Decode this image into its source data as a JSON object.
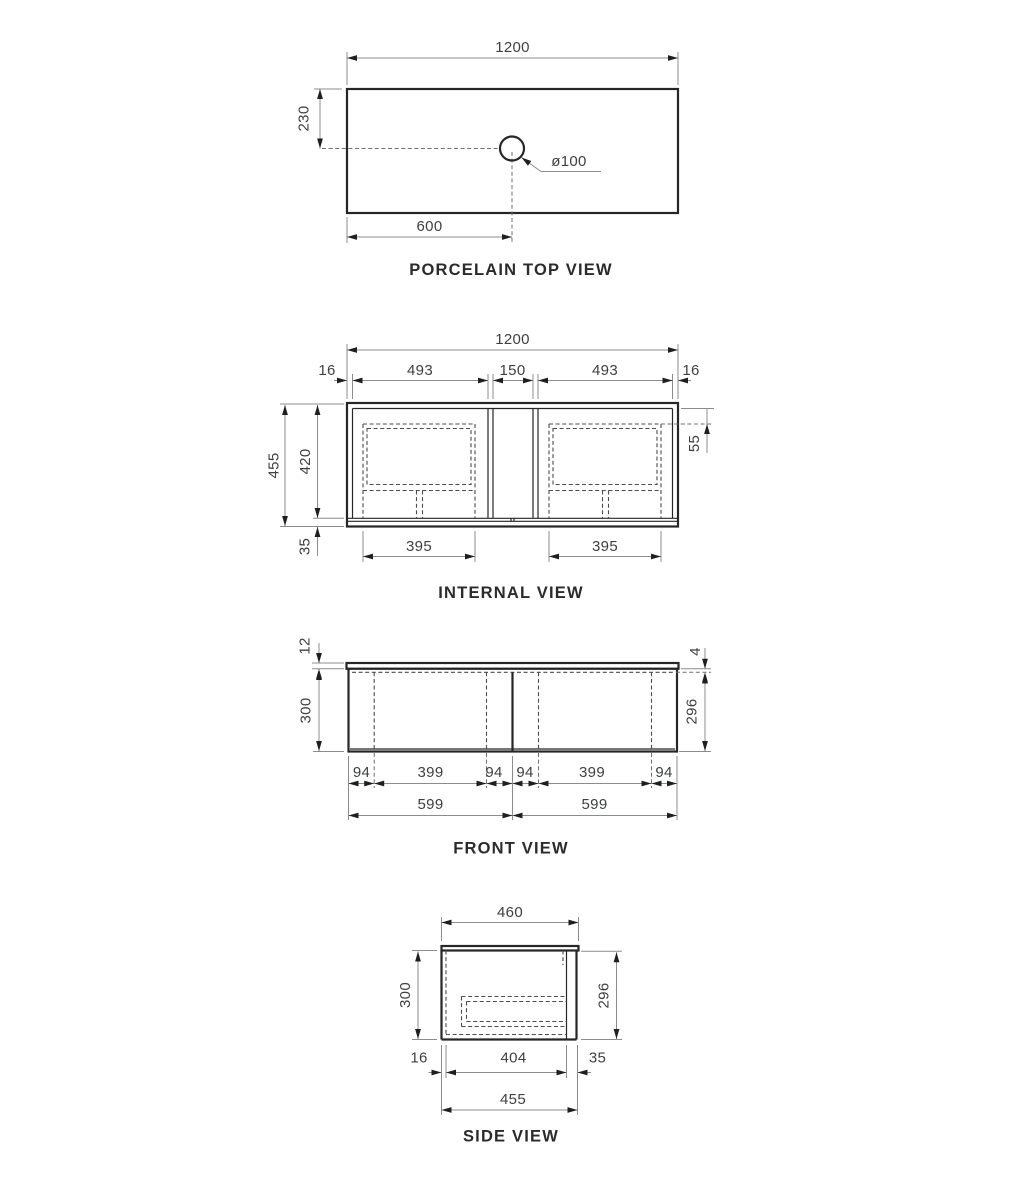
{
  "drawing": {
    "top_view": {
      "title": "PORCELAIN TOP VIEW",
      "width": "1200",
      "hole_offset_front": "230",
      "hole_offset_left": "600",
      "hole_diameter": "ø100"
    },
    "internal_view": {
      "title": "INTERNAL VIEW",
      "overall_width": "1200",
      "panel_left": "16",
      "bay_left_width": "493",
      "center_gap": "150",
      "bay_right_width": "493",
      "panel_right": "16",
      "overall_height": "455",
      "carcass_height": "420",
      "base_height": "35",
      "drawer_top_offset": "55",
      "drawer_left_width": "395",
      "drawer_right_width": "395"
    },
    "front_view": {
      "title": "FRONT VIEW",
      "top_thickness": "12",
      "height_left": "300",
      "top_gap": "4",
      "height_right": "296",
      "edge_left_1": "94",
      "span_left": "399",
      "edge_left_2": "94",
      "edge_right_1": "94",
      "span_right": "399",
      "edge_right_2": "94",
      "door_left_width": "599",
      "door_right_width": "599"
    },
    "side_view": {
      "title": "SIDE VIEW",
      "top_depth": "460",
      "height_left": "300",
      "height_right": "296",
      "back_thickness": "16",
      "internal_depth": "404",
      "front_thickness": "35",
      "overall_depth": "455"
    }
  }
}
